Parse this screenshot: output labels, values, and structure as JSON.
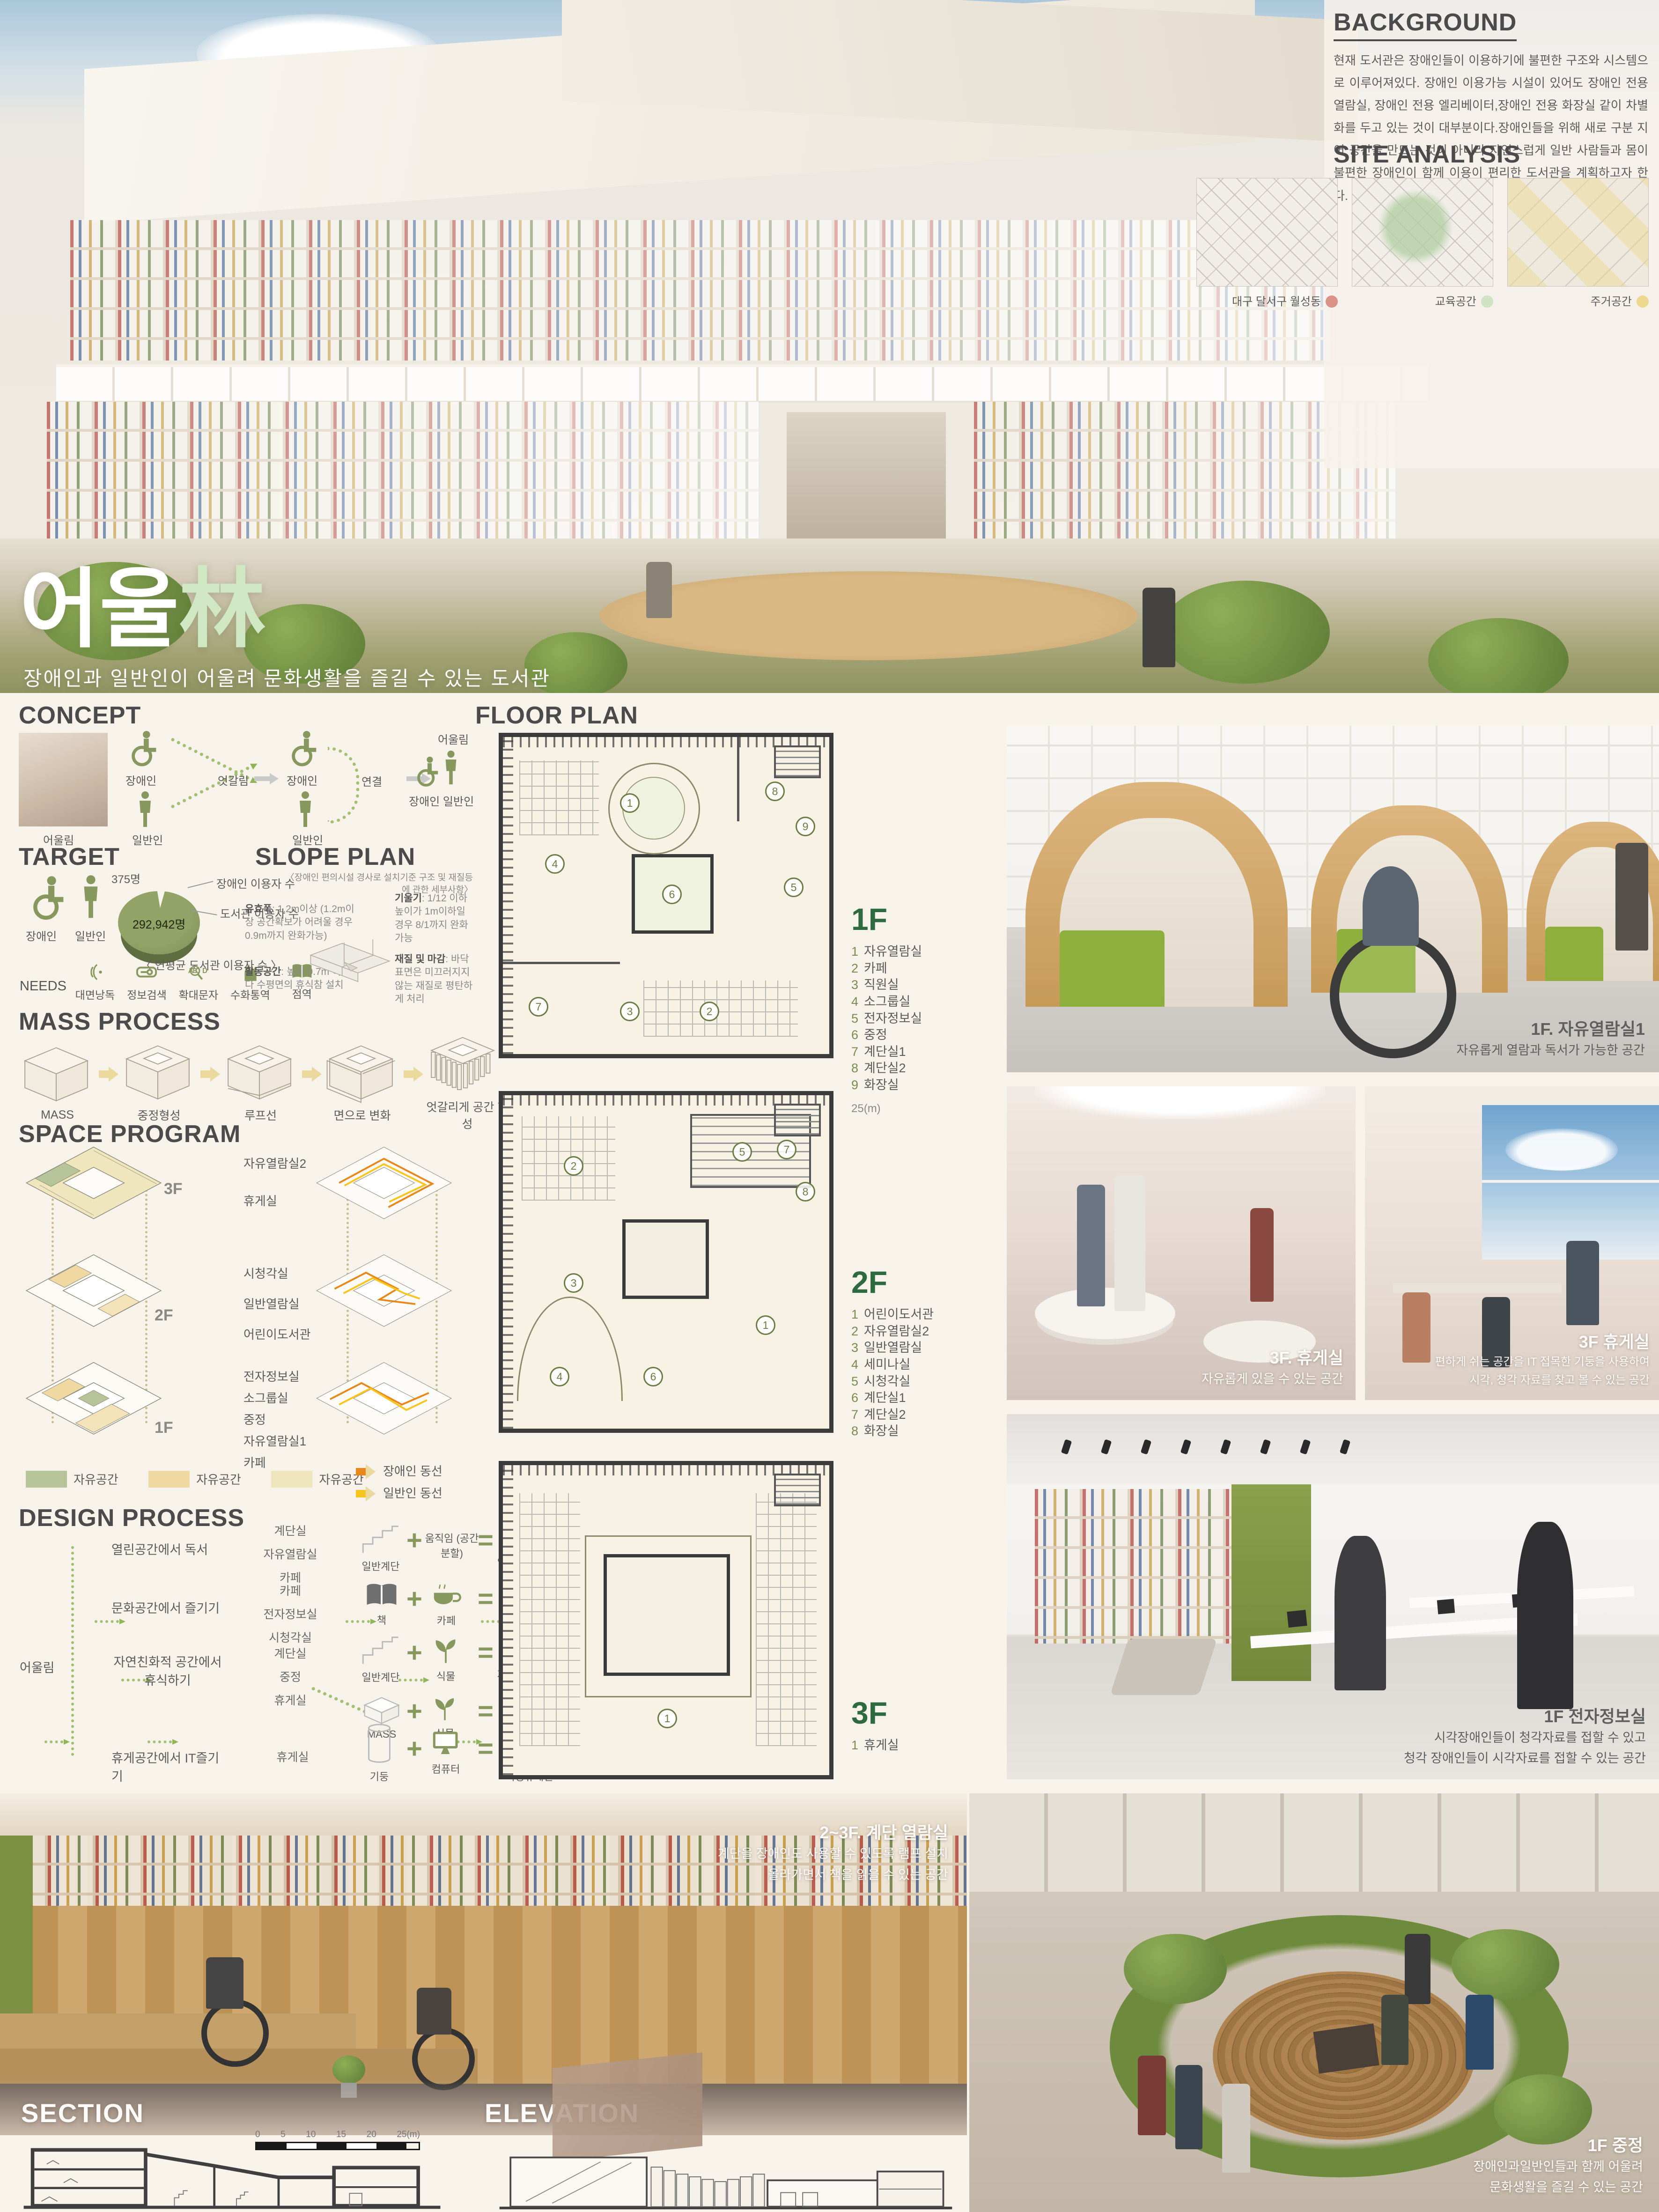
{
  "poster": {
    "hero": {
      "title_kor": "어울",
      "title_hanja": "林",
      "subtitle": "장애인과 일반인이 어울려 문화생활을 즐길 수 있는 도서관"
    },
    "background": {
      "heading": "BACKGROUND",
      "body": "현재 도서관은 장애인들이 이용하기에 불편한 구조와 시스템으로 이루어져있다. 장애인 이용가능 시설이 있어도 장애인 전용 열람실, 장애인 전용 엘리베이터,장애인 전용 화장실 같이 차별화를 두고 있는 것이 대부분이다.장애인들을 위해 새로 구분 지어 공간을 만드는 것이 아니라 자연스럽게 일반 사람들과 몸이 불편한 장애인이 함께 이용이 편리한 도서관을 계획하고자 한다."
    },
    "site_analysis": {
      "heading": "SITE ANALYSIS",
      "maps": [
        {
          "label": "대구 달서구 월성동",
          "dot_color": "#d99286"
        },
        {
          "label": "교육공간",
          "dot_color": "#cfe2c2"
        },
        {
          "label": "주거공간",
          "dot_color": "#ecd98f"
        }
      ]
    },
    "concept": {
      "heading": "CONCEPT",
      "photo_label": "어울림",
      "disabled_label": "장애인",
      "general_label": "일반인",
      "cross_label": "엇갈림",
      "link_label": "연결",
      "merge_label": "어울림",
      "merge_sub": "장애인  일반인"
    },
    "target": {
      "heading": "TARGET",
      "disabled_label": "장애인",
      "general_label": "일반인",
      "pie": {
        "small_value": "375명",
        "small_label": "장애인 이용자 수",
        "big_value": "292,942명",
        "big_label": "도서관 이용자 수",
        "caption": "〈 연평균 도서관  이용자 수 〉"
      },
      "needs_label": "NEEDS",
      "needs": [
        "대면낭독",
        "정보검색",
        "확대문자",
        "수화통역",
        "점역"
      ]
    },
    "slope_plan": {
      "heading": "SLOPE PLAN",
      "subtitle": "〈장애인  편의시설 경사로 설치기준 구조 및 재질등에 관한 세부사항〉",
      "notes": [
        {
          "title": "유효폭",
          "text": ": 1.2m이상 (1.2m이상 공간확보가 어려울 경우 0.9m까지 완화가능)"
        },
        {
          "title": "기울기",
          "text": ": 1/12 이하 높이가 1m이하일 경우 8/1까지 완화가능"
        },
        {
          "title": "활동공간",
          "text": ": 높이 0.7m 이내마다 수평면의 휴식참 설치"
        },
        {
          "title": "재질 및 마감",
          "text": ": 바닥표면은 미끄러지지 않는 재질로 평탄하게 처리"
        }
      ]
    },
    "mass_process": {
      "heading": "MASS PROCESS",
      "steps": [
        "MASS",
        "중정형성",
        "루프선",
        "면으로 변화",
        "엇갈리게 공간 형성"
      ]
    },
    "space_program": {
      "heading": "SPACE PROGRAM",
      "floors": [
        {
          "tag": "3F",
          "rooms": [
            "자유열람실2",
            "휴게실"
          ]
        },
        {
          "tag": "2F",
          "rooms": [
            "시청각실",
            "일반열람실",
            "어린이도서관"
          ]
        },
        {
          "tag": "1F",
          "rooms": [
            "전자정보실",
            "소그룹실",
            "중정",
            "자유열람실1",
            "카페"
          ]
        }
      ],
      "legend": [
        {
          "label": "자유공간",
          "color": "#b7c499"
        },
        {
          "label": "자유공간",
          "color": "#f0d8a3"
        },
        {
          "label": "자유공간",
          "color": "#efe6bd"
        }
      ],
      "circulation": [
        {
          "label": "장애인 동선",
          "color": "#e8871a"
        },
        {
          "label": "일반인 동선",
          "color": "#f7c51e"
        }
      ]
    },
    "design_process": {
      "heading": "DESIGN PROCESS",
      "root": "어울림",
      "rows": [
        {
          "activity": "열린공간에서 독서",
          "spaces": [
            "계단실",
            "자유열람실",
            "카페"
          ],
          "a": "일반계단",
          "b": "움직임 (공간 분할)",
          "result": "엇갈리는 층"
        },
        {
          "activity": "문화공간에서 즐기기",
          "spaces": [
            "카페",
            "전자정보실",
            "시청각실"
          ],
          "a": "책",
          "b": "카페",
          "result": "북카페"
        },
        {
          "activity": "자연친화적 공간에서 휴식하기",
          "spaces": [
            "계단실",
            "중정",
            "휴게실"
          ],
          "a": "일반계단",
          "b": "식물",
          "result": "자연친화적계단",
          "a2": "MASS",
          "b2": "식물",
          "result2": "중정"
        },
        {
          "activity": "휴게공간에서 IT즐기기",
          "spaces": [
            "휴게실"
          ],
          "a": "기둥",
          "b": "컴퓨터",
          "result": "옥상휴게실"
        }
      ]
    },
    "floor_plan": {
      "heading": "FLOOR PLAN",
      "scale_note": "25(m)",
      "floors": [
        {
          "tag": "1F",
          "rooms": [
            "자유열람실",
            "카페",
            "직원실",
            "소그룹실",
            "전자정보실",
            "중정",
            "계단실1",
            "계단실2",
            "화장실"
          ],
          "markers": [
            "1",
            "2",
            "3",
            "4",
            "5",
            "6",
            "7",
            "8",
            "9"
          ]
        },
        {
          "tag": "2F",
          "rooms": [
            "어린이도서관",
            "자유열람실2",
            "일반열람실",
            "세미나실",
            "시청각실",
            "계단실1",
            "계단실2",
            "화장실"
          ],
          "markers": [
            "1",
            "2",
            "3",
            "4",
            "5",
            "6",
            "7",
            "8"
          ]
        },
        {
          "tag": "3F",
          "rooms": [
            "휴게실"
          ],
          "markers": [
            "1"
          ]
        }
      ]
    },
    "renders": {
      "reading_room": {
        "title": "1F. 자유열람실1",
        "lines": [
          "자유롭게 열람과 독서가 가능한 공간"
        ]
      },
      "lounge_a": {
        "title": "3F. 휴게실",
        "lines": [
          "자유롭게 있을 수 있는 공간"
        ]
      },
      "lounge_b": {
        "title": "3F 휴게실",
        "lines": [
          "편하게 쉬는 공간을 IT 접목한 기둥을 사용하여",
          "시각, 청각 자료를 찾고 볼 수 있는 공간"
        ]
      },
      "digital_room": {
        "title": "1F 전자정보실",
        "lines": [
          "시각장애인들이 청각자료를 접할 수 있고",
          "청각 장애인들이 시각자료를 접할 수 있는 공간"
        ]
      },
      "stair_reading": {
        "title": "2~3F. 계단 열람실",
        "lines": [
          "계단을 장애인도 사용할 수 있도록 램프 설치",
          "올라가면서 책을 읽을 수 있는 공간"
        ]
      },
      "courtyard": {
        "title": "1F 중정",
        "lines": [
          "장애인과일반인들과 함께 어울려",
          "문화생활을 즐길 수 있는 공간"
        ]
      }
    },
    "section": {
      "heading": "SECTION"
    },
    "elevation": {
      "heading": "ELEVATION"
    },
    "scale_bar": {
      "ticks": [
        "0",
        "5",
        "10",
        "15",
        "20",
        "25(m)"
      ]
    }
  }
}
